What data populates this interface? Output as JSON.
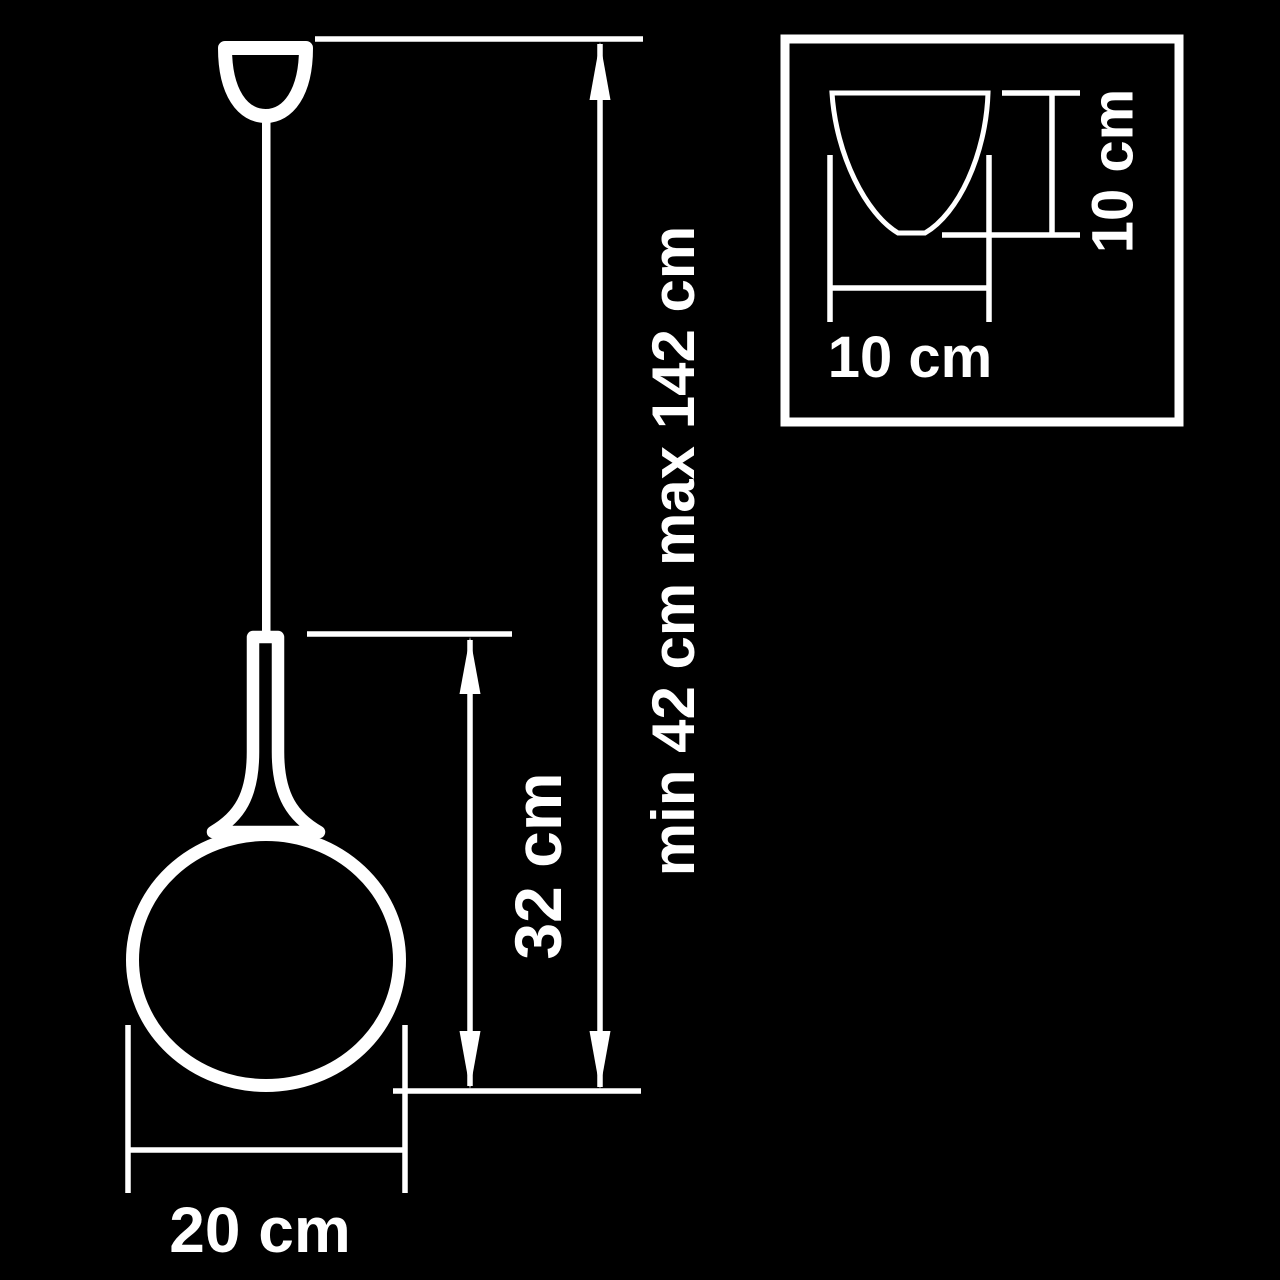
{
  "colors": {
    "background": "#000000",
    "line": "#ffffff"
  },
  "main_drawing": {
    "overall_height_label": "min 42 cm max 142 cm",
    "fixture_height_label": "32 cm",
    "shade_diameter_label": "20 cm"
  },
  "inset": {
    "canopy_width_label": "10 cm",
    "canopy_height_label": "10 cm"
  }
}
